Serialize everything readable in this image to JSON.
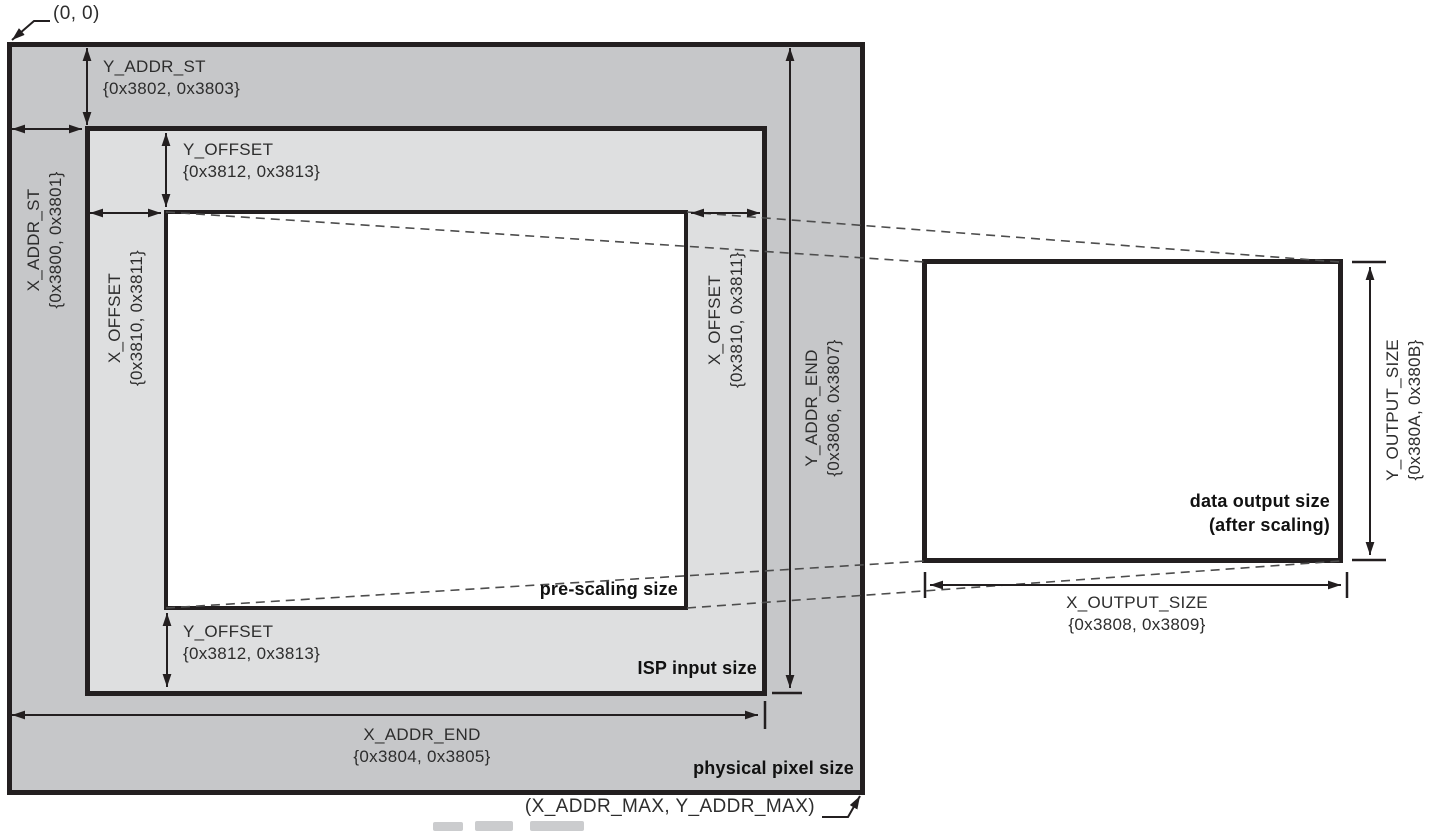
{
  "figure": {
    "origin_label": "(0, 0)",
    "max_label": "(X_ADDR_MAX, Y_ADDR_MAX)",
    "region_labels": {
      "physical_pixel_size": "physical pixel size",
      "isp_input_size": "ISP input size",
      "pre_scaling_size": "pre-scaling size",
      "data_output_size_line1": "data output size",
      "data_output_size_line2": "(after scaling)"
    },
    "dimensions": {
      "y_addr_st": {
        "label": "Y_ADDR_ST",
        "registers": "{0x3802, 0x3803}"
      },
      "x_addr_st": {
        "label": "X_ADDR_ST",
        "registers": "{0x3800, 0x3801}"
      },
      "y_offset_top": {
        "label": "Y_OFFSET",
        "registers": "{0x3812, 0x3813}"
      },
      "x_offset_left": {
        "label": "X_OFFSET",
        "registers": "{0x3810, 0x3811}"
      },
      "x_offset_right": {
        "label": "X_OFFSET",
        "registers": "{0x3810, 0x3811}"
      },
      "y_addr_end": {
        "label": "Y_ADDR_END",
        "registers": "{0x3806, 0x3807}"
      },
      "y_offset_bottom": {
        "label": "Y_OFFSET",
        "registers": "{0x3812, 0x3813}"
      },
      "x_addr_end": {
        "label": "X_ADDR_END",
        "registers": "{0x3804, 0x3805}"
      },
      "x_output_size": {
        "label": "X_OUTPUT_SIZE",
        "registers": "{0x3808, 0x3809}"
      },
      "y_output_size": {
        "label": "Y_OUTPUT_SIZE",
        "registers": "{0x380A, 0x380B}"
      }
    },
    "colors": {
      "physical_fill": "#c6c7c9",
      "isp_fill": "#dedfe0",
      "window_fill": "#ffffff",
      "line_black": "#231f20",
      "text": "#2d2d2d",
      "dashed_line": "#4d4d4d"
    }
  }
}
